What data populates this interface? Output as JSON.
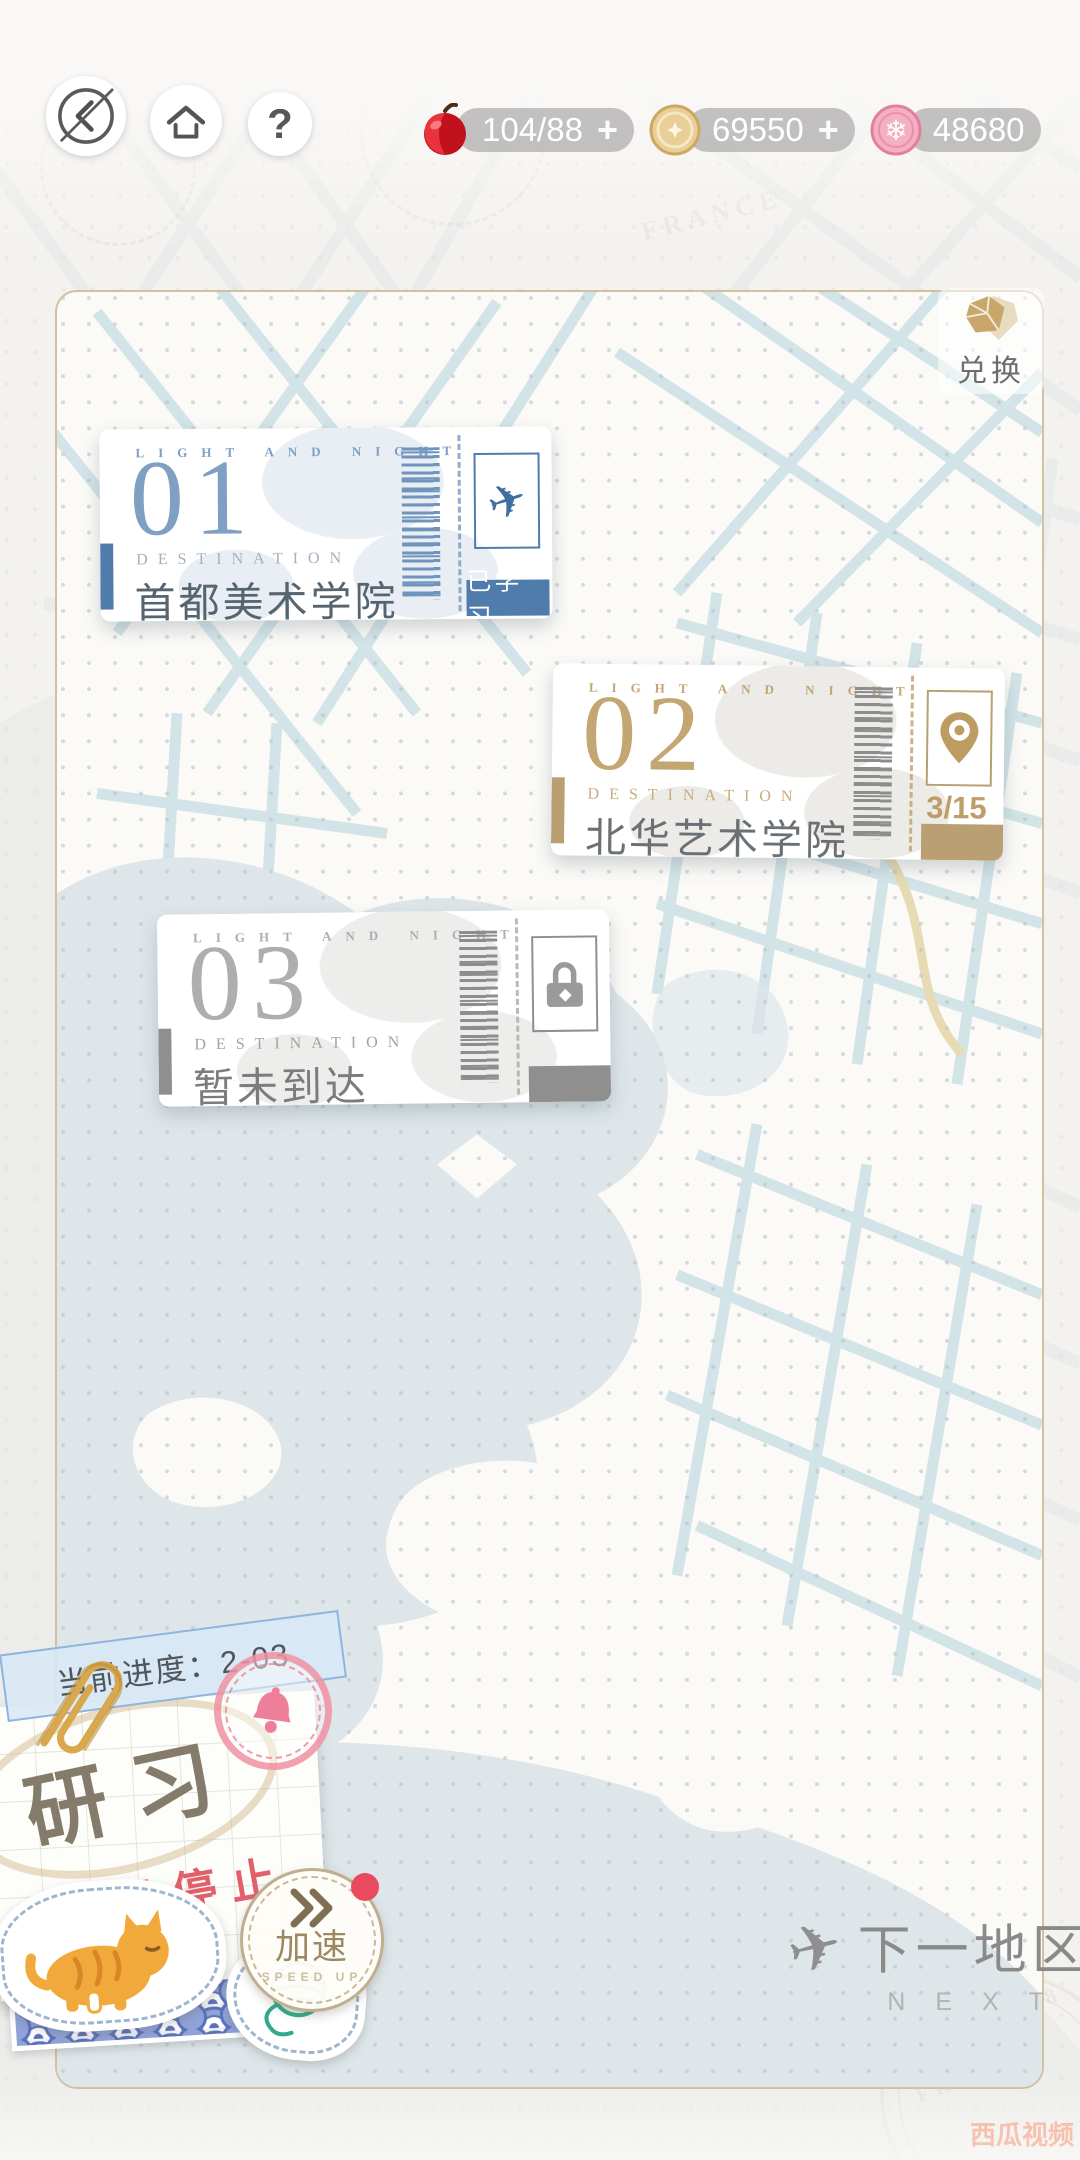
{
  "topbar": {
    "help_label": "?",
    "currencies": [
      {
        "name": "apple",
        "value": "104/88",
        "plus": "+"
      },
      {
        "name": "gold-coin",
        "value": "69550",
        "plus": "+"
      },
      {
        "name": "pink-coin",
        "value": "48680"
      }
    ]
  },
  "map": {
    "exchange_label": "兑换"
  },
  "tickets": [
    {
      "brand": "LIGHT AND NIGHT",
      "number": "01",
      "dest_label": "DESTINATION",
      "name": "首都美术学院",
      "status": "已学习",
      "icon": "plane"
    },
    {
      "brand": "LIGHT AND NIGHT",
      "number": "02",
      "dest_label": "DESTINATION",
      "name": "北华艺术学院",
      "progress": "3/15",
      "icon": "location-pin"
    },
    {
      "brand": "LIGHT AND NIGHT",
      "number": "03",
      "dest_label": "DESTINATION",
      "name": "暂未到达",
      "icon": "lock"
    }
  ],
  "progress_note": {
    "label": "当前进度：2-03",
    "title": "研习",
    "status": "已停止"
  },
  "speedup": {
    "label": "加速",
    "sublabel": "SPEED UP"
  },
  "next_area": {
    "label": "下一地区",
    "sublabel": "NEXT"
  },
  "watermark": "西瓜视频",
  "background": {
    "stamps": {
      "paris": "PARIS",
      "date": "21 JAN 2018",
      "france": "FRANCE"
    }
  },
  "colors": {
    "ticket_blue": "#4f7cab",
    "ticket_gold": "#b99f72",
    "ticket_gray": "#8f8f8f",
    "frame_border": "#c9b68e",
    "badge_red_dot": "#ea4a5e",
    "stopped_red": "#e2606b",
    "map_street": "#cfe2e7",
    "lake": "#dee6ea"
  }
}
